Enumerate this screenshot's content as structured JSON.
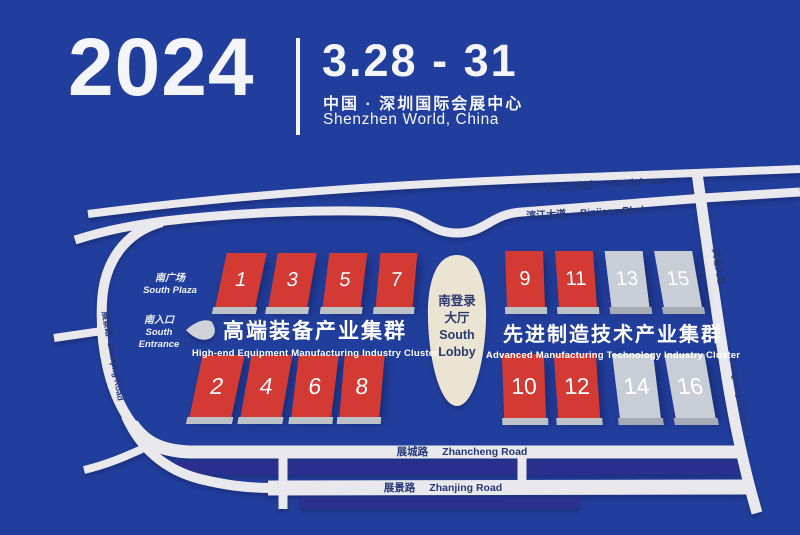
{
  "header": {
    "year": "2024",
    "dates": "3.28 - 31",
    "venue_cn": "中国 · 深圳国际会展中心",
    "venue_en": "Shenzhen World, China"
  },
  "map": {
    "colors": {
      "background": "#223e9c",
      "road": "#e9e9ed",
      "navy_band": "#2d2f8e",
      "hall_red": "#d23a33",
      "hall_gray": "#c9ced6",
      "lobby": "#ece4d2"
    },
    "roads": {
      "s3": {
        "cn": "广深沿江高速",
        "en": "S3 Highway"
      },
      "binjiang": {
        "cn": "滨江大道",
        "en": "Binjiang Blvd"
      },
      "zhancheng": {
        "cn": "展城路",
        "en": "Zhancheng Road"
      },
      "zhanjing": {
        "cn": "展景路",
        "en": "Zhanjing Road"
      },
      "zhanjing_west": {
        "cn": "展景路",
        "en": "Zhanjing Road"
      },
      "fengtang": {
        "cn": "凤塘大道",
        "en": "Fengtang Avenue"
      }
    },
    "places": {
      "south_plaza": {
        "cn": "南广场",
        "en": "South Plaza"
      },
      "south_entrance": {
        "cn": "南入口",
        "en1": "South",
        "en2": "Entrance"
      },
      "south_lobby": {
        "cn1": "南登录",
        "cn2": "大厅",
        "en1": "South",
        "en2": "Lobby"
      }
    },
    "clusters": {
      "left": {
        "cn": "高端装备产业集群",
        "en": "High-end Equipment Manufacturing Industry Cluster"
      },
      "right": {
        "cn": "先进制造技术产业集群",
        "en": "Advanced Manufacturing Technology Industry Cluster"
      }
    },
    "halls": [
      {
        "num": "1",
        "color": "red"
      },
      {
        "num": "3",
        "color": "red"
      },
      {
        "num": "5",
        "color": "red"
      },
      {
        "num": "7",
        "color": "red"
      },
      {
        "num": "9",
        "color": "red"
      },
      {
        "num": "11",
        "color": "red"
      },
      {
        "num": "13",
        "color": "gray"
      },
      {
        "num": "15",
        "color": "gray"
      },
      {
        "num": "2",
        "color": "red"
      },
      {
        "num": "4",
        "color": "red"
      },
      {
        "num": "6",
        "color": "red"
      },
      {
        "num": "8",
        "color": "red"
      },
      {
        "num": "10",
        "color": "red"
      },
      {
        "num": "12",
        "color": "red"
      },
      {
        "num": "14",
        "color": "gray"
      },
      {
        "num": "16",
        "color": "gray"
      }
    ]
  }
}
